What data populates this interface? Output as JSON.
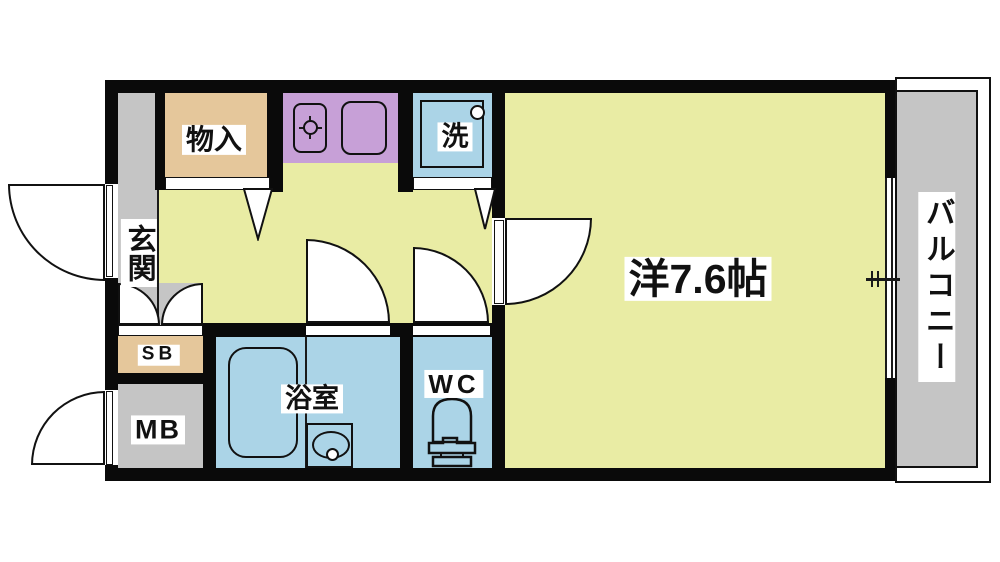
{
  "floorplan": {
    "type": "apartment-1K-floor-plan",
    "rooms": {
      "entrance": "玄関",
      "storage": "物入",
      "laundry": "洗",
      "shoe_box": "SB",
      "meter_box": "MB",
      "bathroom": "浴室",
      "toilet": "WC",
      "main_room": "洋7.6帖",
      "balcony": "バルコニー"
    },
    "colors": {
      "wall": "#0a0a0a",
      "floor_yellow": "#e9eca4",
      "floor_gray": "#c5c5c5",
      "floor_tan": "#e5c79b",
      "counter_purple": "#c7a0d7",
      "water_blue": "#abd4e7"
    }
  }
}
